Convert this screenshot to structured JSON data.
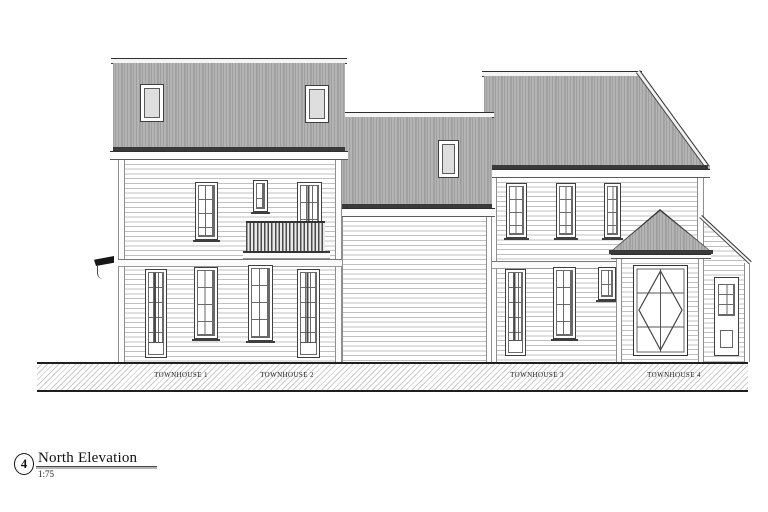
{
  "drawing": {
    "detail_number": "4",
    "title": "North Elevation",
    "scale": "1:75",
    "unit_labels": [
      "TOWNHOUSE 1",
      "TOWNHOUSE 2",
      "TOWNHOUSE 3",
      "TOWNHOUSE 4"
    ]
  },
  "colors": {
    "paper": "#ffffff",
    "line": "#3a3a3a",
    "roof-fill": "#b4b4b4",
    "roof-stripe": "#9f9f9f",
    "clap-line": "#c0c0c0",
    "hatch-line": "#cccccc"
  }
}
